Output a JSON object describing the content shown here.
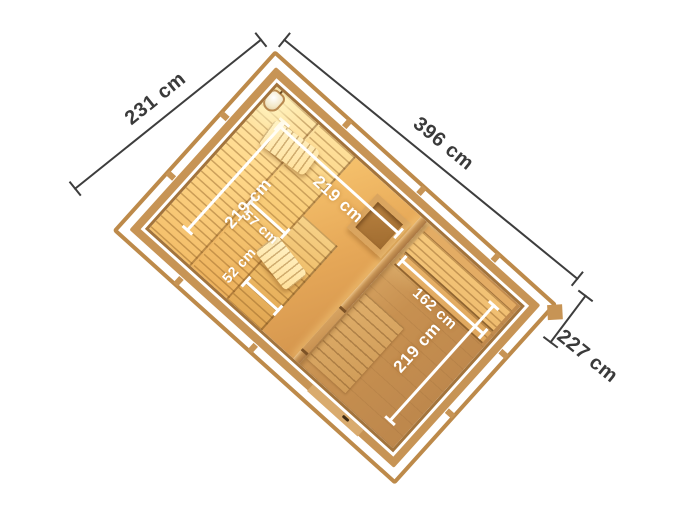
{
  "illustration": {
    "type": "isometric sauna-house floor plan with dimensions",
    "background": "#ffffff"
  },
  "outer_dimensions": {
    "left_side": {
      "label": "231 cm"
    },
    "top_side": {
      "label": "396 cm"
    },
    "right_side": {
      "label": "227 cm"
    }
  },
  "inner_dimensions": {
    "sauna_left_wall": {
      "label": "219 cm"
    },
    "sauna_top_wall": {
      "label": "219 cm"
    },
    "anteroom_right_wall": {
      "label": "219 cm"
    },
    "anteroom_bench": {
      "label": "162 cm"
    },
    "sauna_bench_middle": {
      "label": "57 cm"
    },
    "sauna_bench_lower": {
      "label": "52 cm"
    }
  },
  "objects": [
    "sauna-lamp",
    "sauna-heater",
    "upper-bench",
    "middle-bench",
    "lower-bench",
    "headrest-front",
    "headrest-rear",
    "anteroom-bench",
    "floor-grating",
    "partition-doorway",
    "entrance-door-handle"
  ],
  "colors": {
    "wood_frame": "#c79455",
    "wood_dark": "#a3743c",
    "sauna_glow": "#ffe9ae",
    "sauna_floor": "#f4bf6a",
    "anteroom_floor": "#c79050",
    "dimension_line": "#3d3d3d",
    "inner_dimension_text": "#ffffff",
    "background": "#ffffff"
  }
}
